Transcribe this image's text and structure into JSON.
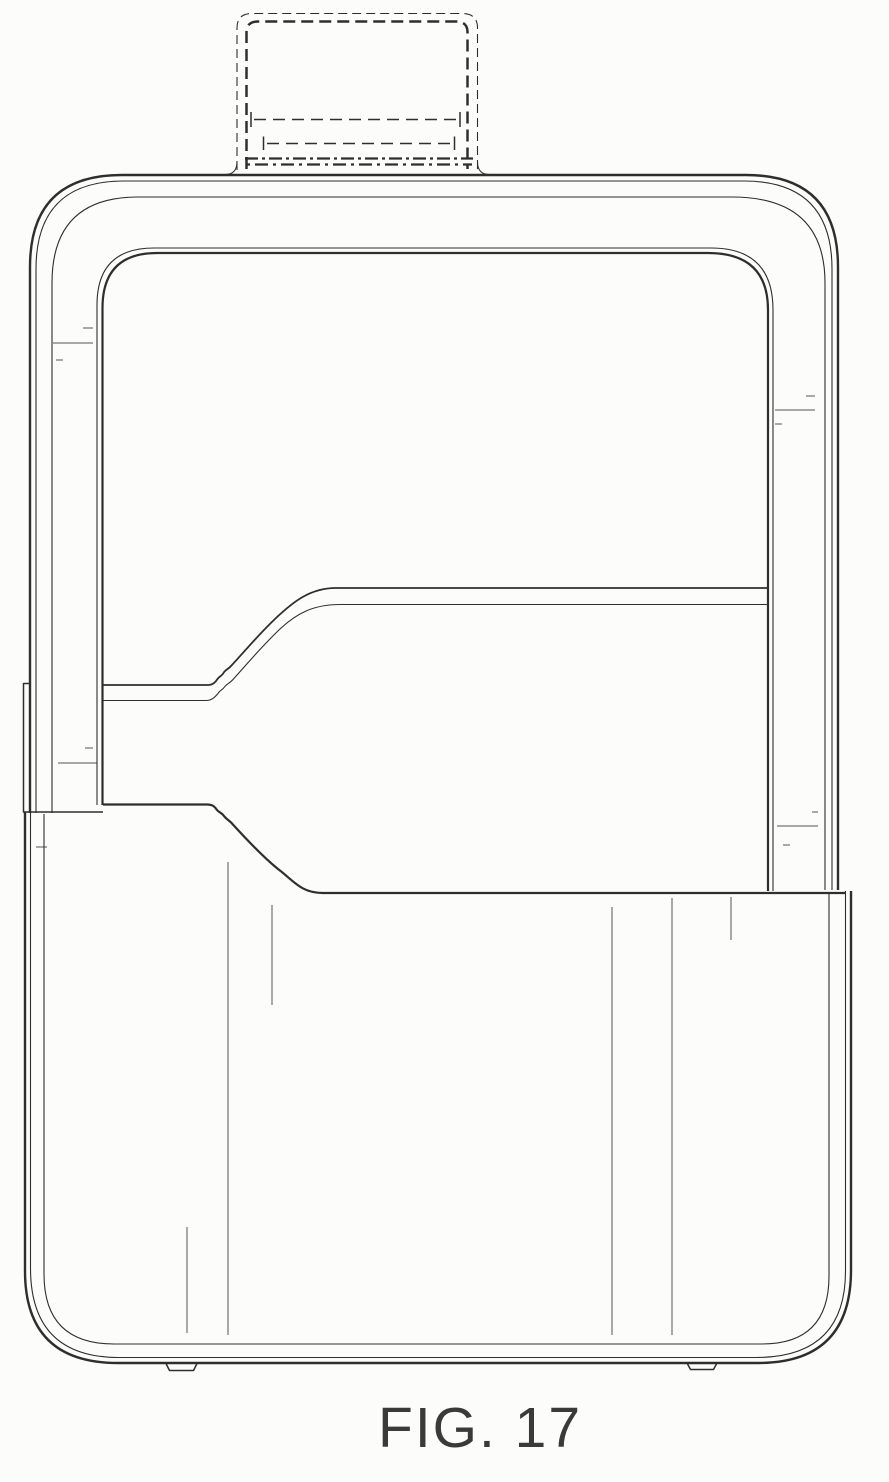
{
  "figure": {
    "caption": "FIG. 17"
  },
  "colors": {
    "ink": "#2e2e2e",
    "paper": "#fcfcfb"
  }
}
